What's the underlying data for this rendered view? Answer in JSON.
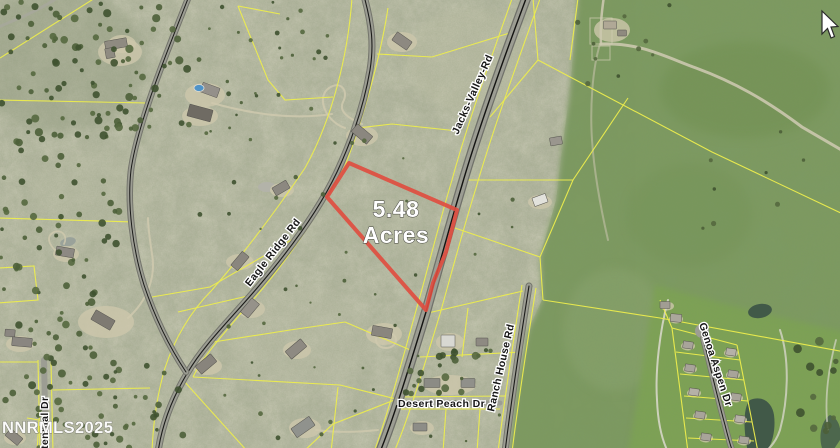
{
  "map": {
    "parcel": {
      "acreage_line1": "5.48",
      "acreage_line2": "Acres",
      "outline_color": "#e04b3e"
    },
    "road_labels": {
      "jacks_valley": "Jacks-Valley-Rd",
      "eagle_ridge": "Eagle Ridge Rd",
      "ranch_house": "Ranch House Rd",
      "desert_peach": "Desert Peach Dr",
      "centennial": "Centennial Dr",
      "genoa_aspen": "Genoa Aspen Dr"
    },
    "watermark": "NNRMLS2025",
    "colors": {
      "scrub": "#b5b8a2",
      "meadow": "#7d9a61",
      "golf": "#7da352",
      "road": "#9c9d93",
      "parcel_line": "#eded4d",
      "label_fill": "#161616",
      "label_halo": "#ffffff"
    },
    "cursor": "pointer-arrow"
  }
}
